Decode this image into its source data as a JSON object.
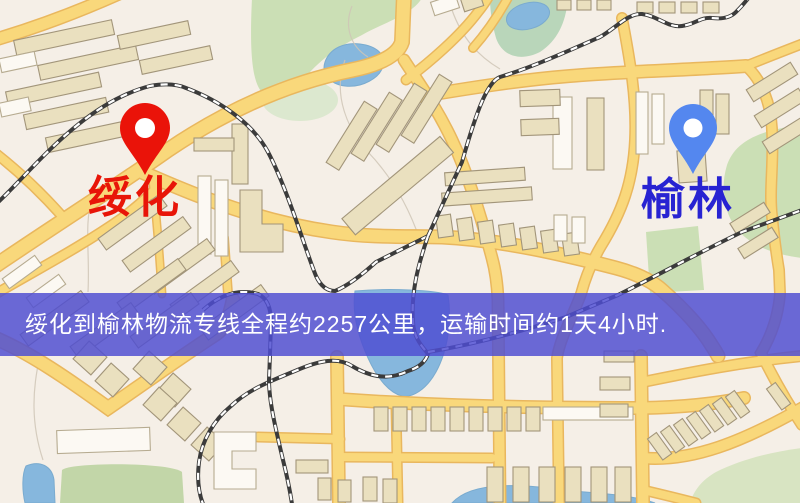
{
  "page": {
    "kind": "logistics-route-map",
    "width": 800,
    "height": 503
  },
  "banner": {
    "text": "绥化到榆林物流专线全程约2257公里，运输时间约1天4小时.",
    "background_color": "#4f4dd2",
    "text_color": "#ffffff"
  },
  "origin": {
    "label": "绥化",
    "label_color": "#e81508",
    "pin_color": "#ea1309",
    "pin_icon": "map-pin"
  },
  "destination": {
    "label": "榆林",
    "label_color": "#2823d2",
    "pin_color": "#5487ef",
    "pin_icon": "map-pin"
  },
  "map_colors": {
    "background": "#f5efe7",
    "road_fill": "#f9d87b",
    "road_casing": "#e9b75e",
    "water": "#86b7dd",
    "green_area": "#cbdfb5",
    "building": "#eae0bf",
    "building_light": "#fcf9f3",
    "railway_dark": "#3b3b3b",
    "railway_dash": "#ffffff"
  }
}
